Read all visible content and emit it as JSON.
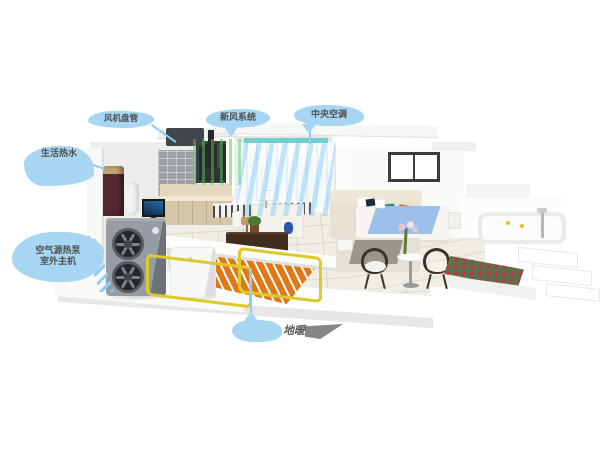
{
  "illustration": {
    "type": "heat-pump-smart-home-cutaway"
  },
  "callouts": {
    "fan_coil": "风机盘管",
    "fresh_air": "新风系统",
    "central_ac": "中央空调",
    "hot_water": "生活热水",
    "heat_pump_line1": "空气源热泵",
    "heat_pump_line2": "室外主机",
    "floor_heating": "地暖"
  },
  "colors": {
    "callout_bubble": "#a6d6f2",
    "callout_text": "#4f4f4f",
    "pointer_line": "#8ecdf0",
    "pipe_yellow": "#ddc92a",
    "floor_coil_orange": "#e07818",
    "fresh_air_green": "#55c561",
    "cool_air_blue": "#7dc6f6",
    "vent_teal": "#5ec8c8",
    "heat_pump_gray": "#959ca3",
    "hydro_tank_white": "#f6f7f8",
    "cabinet_wood": "#d6c6a8",
    "bed_blue": "#9cc0ea",
    "rose_red": "#c22f48",
    "background": "#ffffff"
  }
}
